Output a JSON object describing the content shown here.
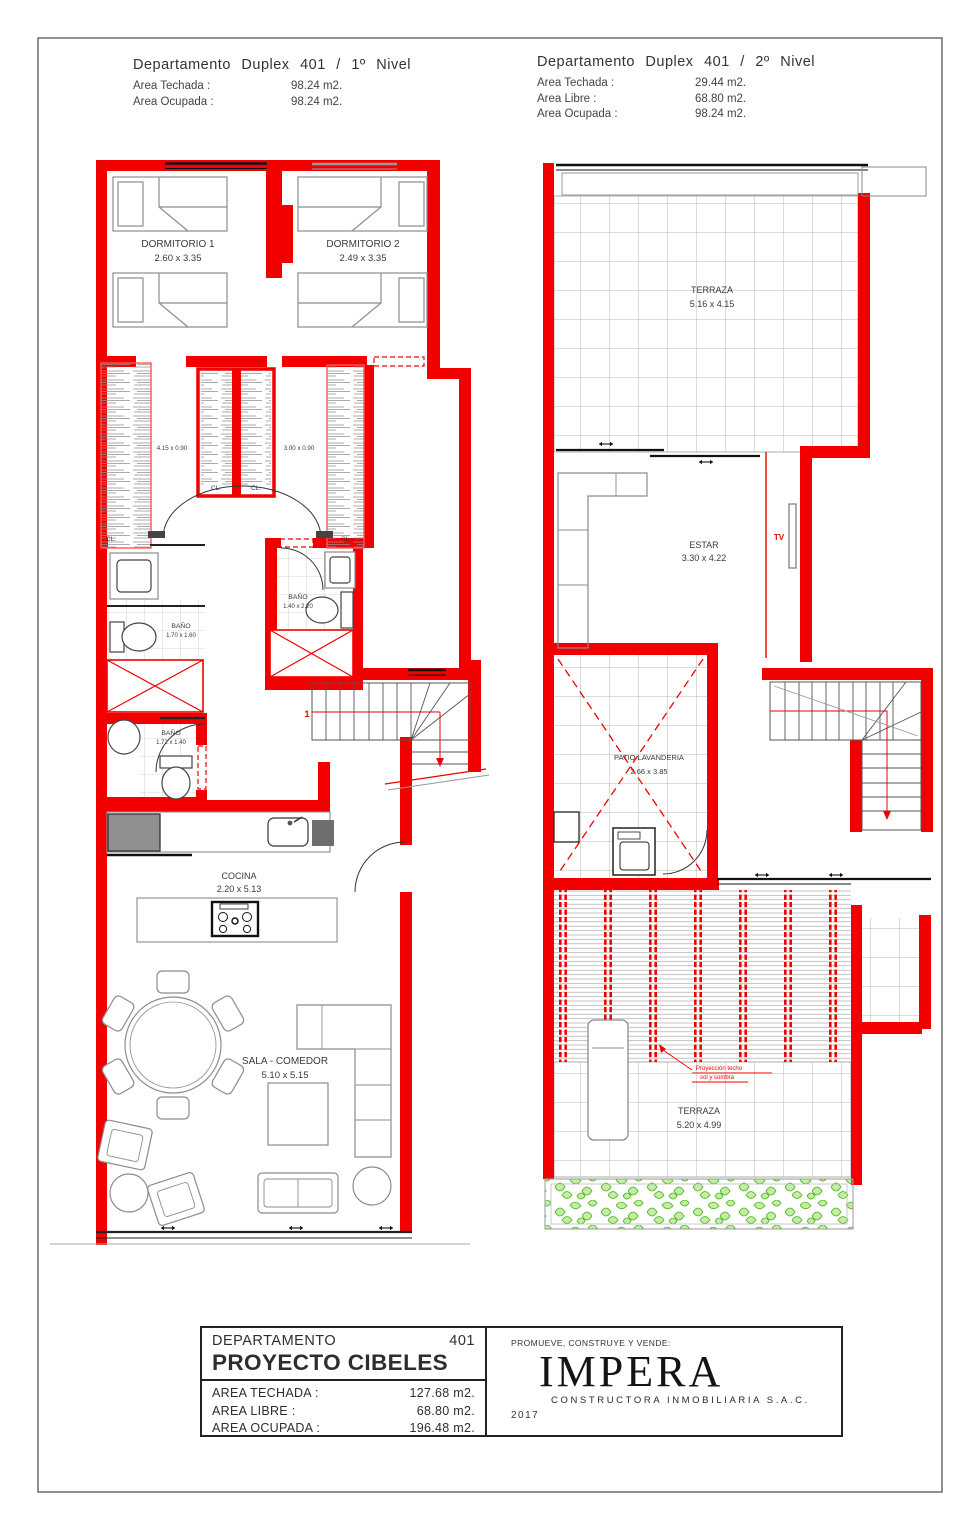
{
  "colors": {
    "wall_red": "#f20000",
    "annotation_red": "#f20000",
    "furniture_gray": "#8c8c8c",
    "tile_gray": "#a3a3a3",
    "plant_green": "#55c41c",
    "window_black": "#1a1a1a",
    "text_dark": "#3a3a3a"
  },
  "header_level1": {
    "title": "Departamento Duplex 401 / 1º Nivel",
    "rows": [
      {
        "label": "Area Techada :",
        "value": "98.24 m2."
      },
      {
        "label": "Area Ocupada :",
        "value": "98.24 m2."
      }
    ]
  },
  "header_level2": {
    "title": "Departamento Duplex 401 / 2º Nivel",
    "rows": [
      {
        "label": "Area Techada :",
        "value": "29.44 m2."
      },
      {
        "label": "Area Libre      :",
        "value": "68.80 m2."
      },
      {
        "label": "Area Ocupada :",
        "value": "98.24 m2."
      }
    ]
  },
  "level1": {
    "dormitorio1": {
      "name": "DORMITORIO 1",
      "dims": "2.60 x 3.35"
    },
    "dormitorio2": {
      "name": "DORMITORIO 2",
      "dims": "2.49 x 3.35"
    },
    "closet_left_dims": "4.15 x 0.90",
    "closet_right_dims": "3.00 x 0.90",
    "closet_label": "CL.",
    "bano1": {
      "name": "BAÑO",
      "dims": "1.70 x 1.60"
    },
    "bano2": {
      "name": "BAÑO",
      "dims": "1.40 x 2.20"
    },
    "bano3": {
      "name": "BAÑO",
      "dims": "1.72 x 1.40"
    },
    "cocina": {
      "name": "COCINA",
      "dims": "2.20 x 5.13"
    },
    "sala": {
      "name": "SALA - COMEDOR",
      "dims": "5.10 x 5.15"
    },
    "stair_number": "1"
  },
  "level2": {
    "terraza_top": {
      "name": "TERRAZA",
      "dims": "5.16 x 4.15"
    },
    "estar": {
      "name": "ESTAR",
      "dims": "3.30 x 4.22"
    },
    "tv": "TV",
    "patio": {
      "name": "PATIO LAVANDERIA",
      "dims": "2.66 x 3.85"
    },
    "terraza_bottom": {
      "name": "TERRAZA",
      "dims": "5.20 x 4.99"
    },
    "annotation_line1": "Proyección techo",
    "annotation_line2": "sol y sombra"
  },
  "title_block": {
    "departamento_label": "DEPARTAMENTO",
    "unit_number": "401",
    "project_name": "PROYECTO CIBELES",
    "rows": [
      {
        "label": "AREA  TECHADA  :",
        "value": "127.68  m2."
      },
      {
        "label": "AREA  LIBRE       :",
        "value": "68.80  m2."
      },
      {
        "label": "AREA  OCUPADA  :",
        "value": "196.48  m2."
      }
    ],
    "promoter_caption": "PROMUEVE, CONSTRUYE Y VENDE:",
    "brand": "IMPERA",
    "brand_subtitle": "CONSTRUCTORA   INMOBILIARIA  S.A.C.",
    "year": "2017"
  }
}
